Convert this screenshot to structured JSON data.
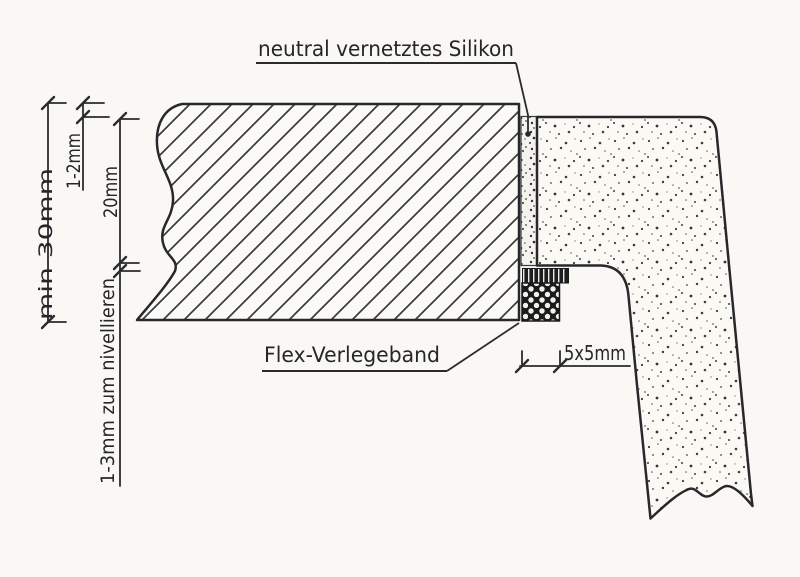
{
  "drawing": {
    "labels": {
      "silicone": "neutral vernetztes Silikon",
      "flex_tape": "Flex-Verlegeband"
    },
    "dimensions": {
      "countertop_thickness": "min 30mm",
      "top_gap": "1-2mm",
      "wall_panel_height": "20mm",
      "leveling_gap": "1-3mm zum nivellieren",
      "tape_size": "5x5mm"
    },
    "colors": {
      "paper": "#f9f8f4",
      "line": "#2b2b2e",
      "hatch": "#3a3a42",
      "stipple": "#3c3c3c",
      "tape_dark": "#1b1b1d"
    }
  }
}
